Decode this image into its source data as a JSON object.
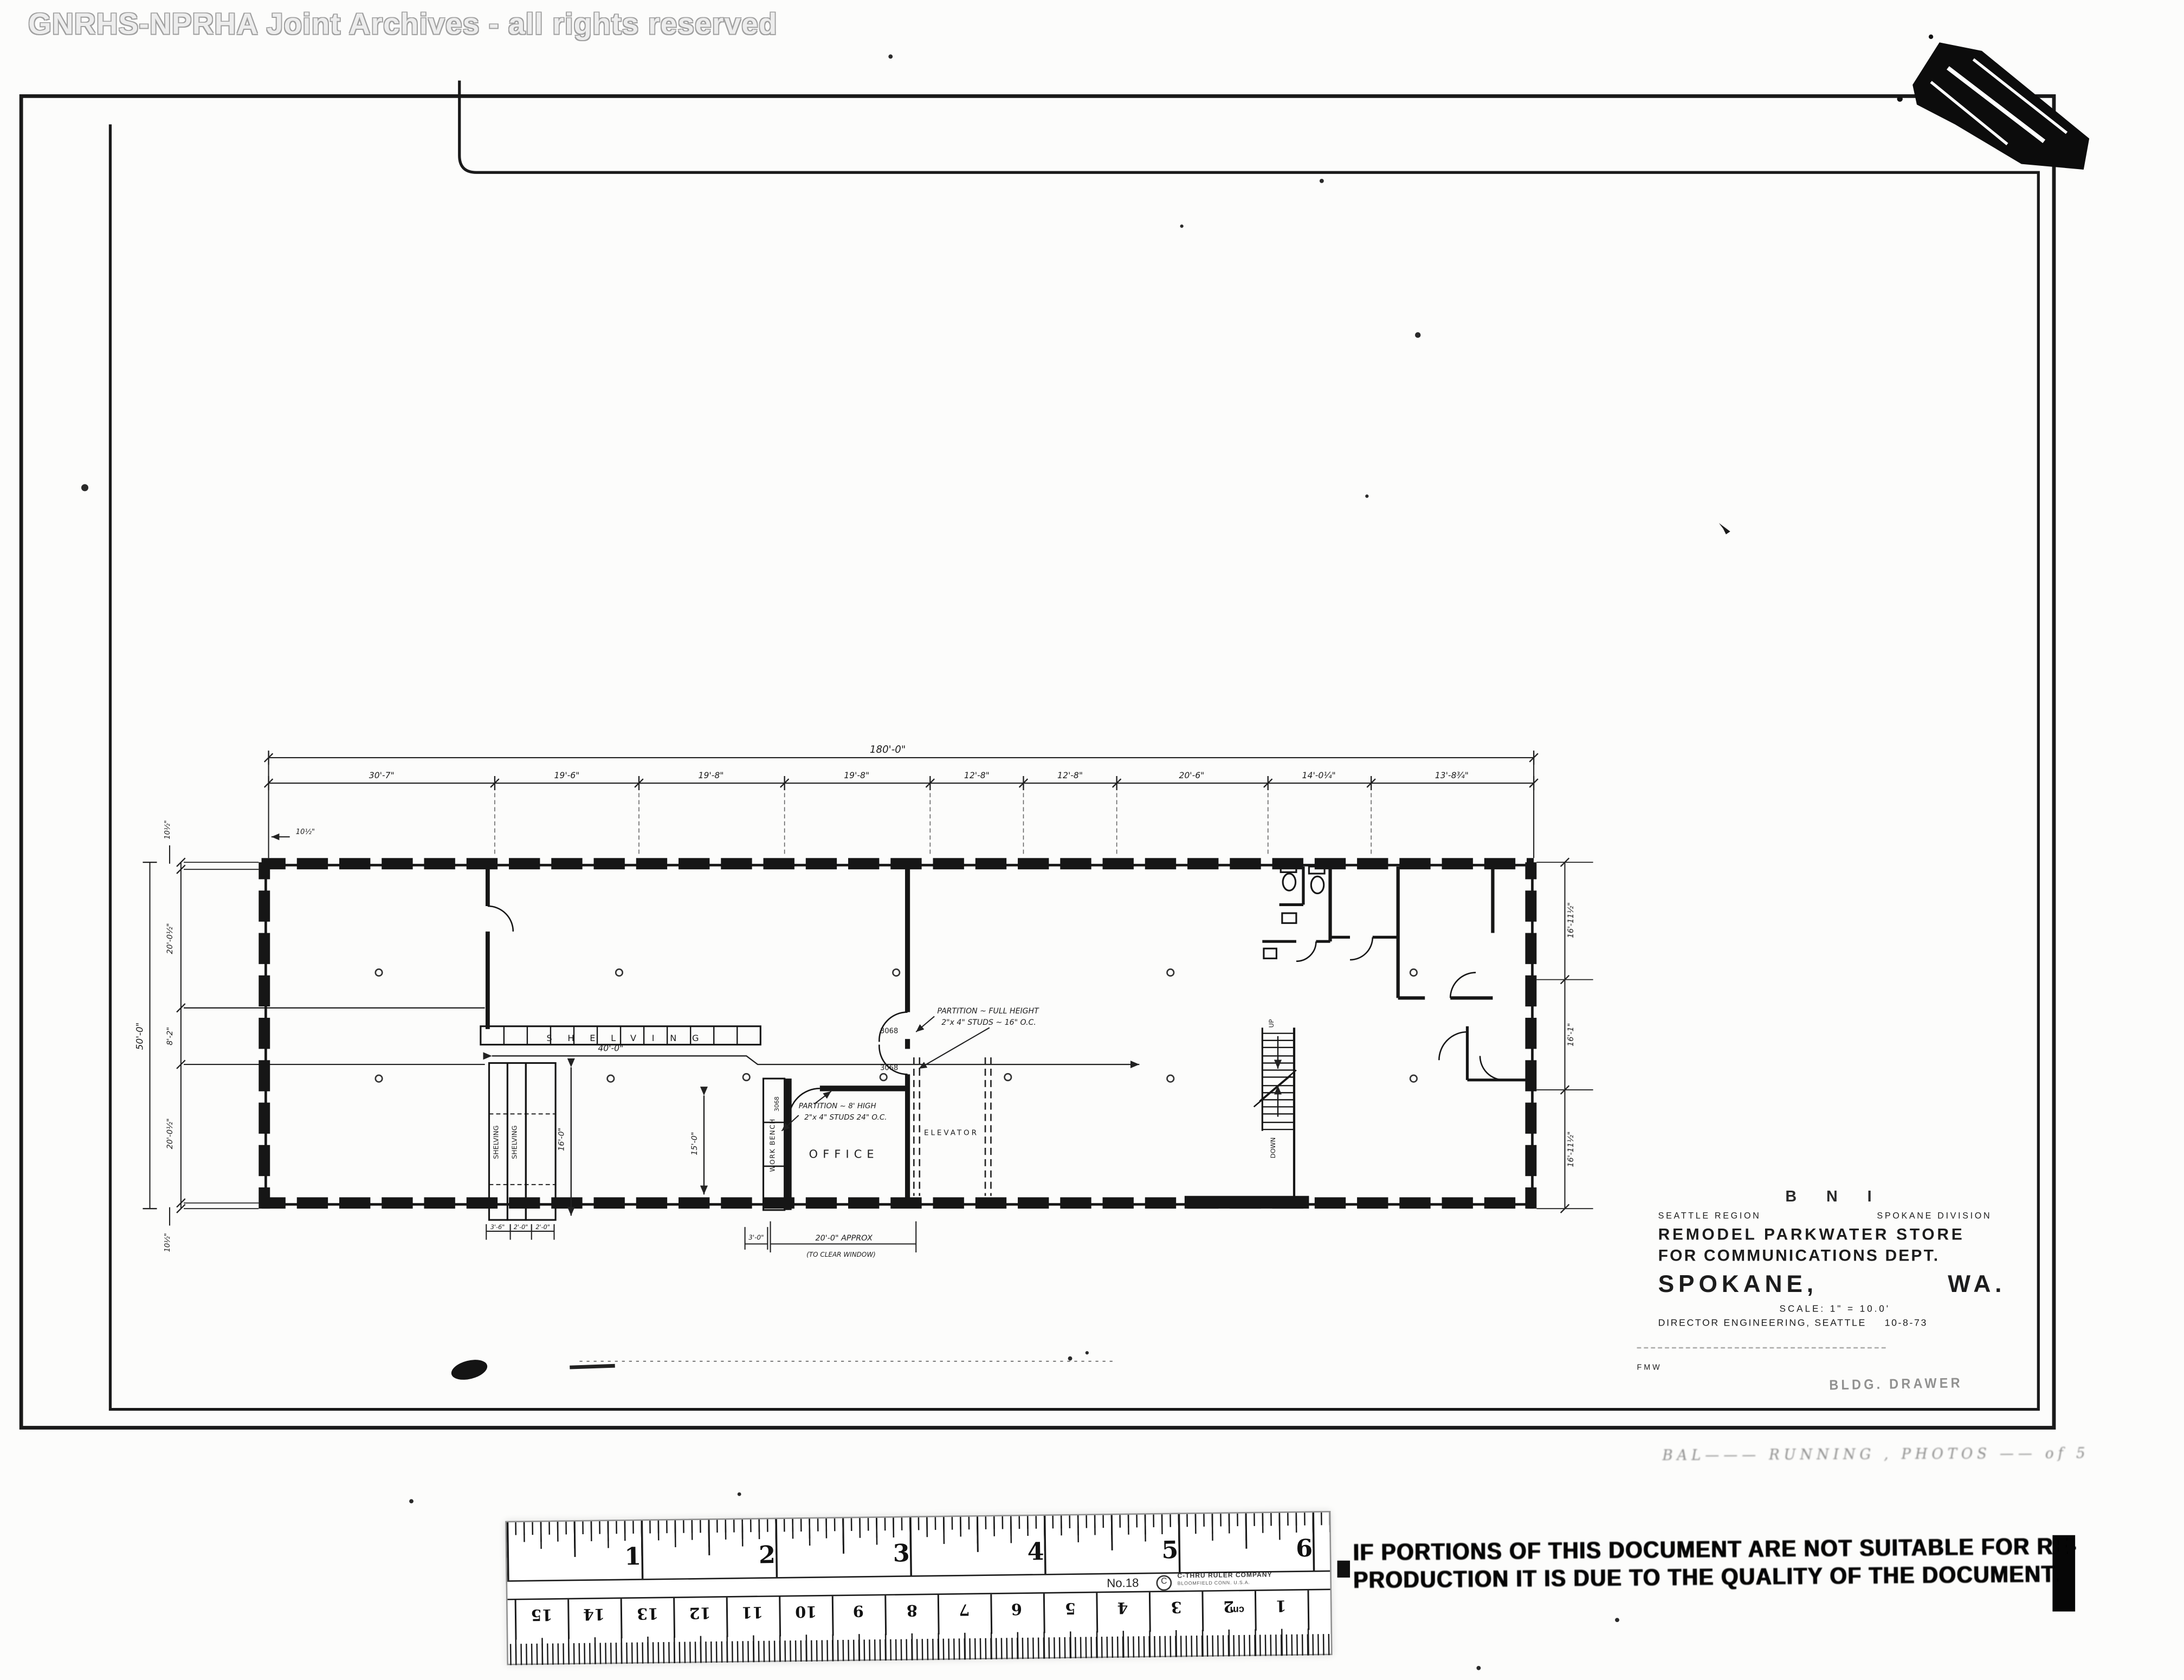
{
  "watermark": "GNRHS-NPRHA Joint Archives - all rights reserved",
  "plan": {
    "dim_overall_top": "180'-0\"",
    "dim_segments_top": [
      "30'-7\"",
      "19'-6\"",
      "19'-8\"",
      "19'-8\"",
      "12'-8\"",
      "12'-8\"",
      "20'-6\"",
      "14'-0¼\"",
      "13'-8¾\""
    ],
    "dim_offset_top_left": "10½\"",
    "dim_left": {
      "overall": "50'-0\"",
      "top_offset": "10½\"",
      "upper": "20'-0½\"",
      "middle": "8'-2\"",
      "lower": "20'-0½\"",
      "bottom_offset": "10½\""
    },
    "dim_right": {
      "top": "16'-11½\"",
      "middle": "16'-1\"",
      "bottom": "16'-11½\""
    },
    "dim_shelving_run": "40'-0\"",
    "dim_shelf_depth": "16'-0\"",
    "dim_office": "15'-0\"",
    "dim_shelf_widths": [
      "3'-6\"",
      "2'-0\"",
      "2'-0\""
    ],
    "dim_door": "3'-0\"",
    "dim_window": "20'-0\" APPROX",
    "dim_window_note": "(TO CLEAR WINDOW)",
    "labels": {
      "shelving_band": "SHELVING",
      "shelving_col_1": "SHELVING",
      "shelving_col_2": "SHELVING",
      "work_bench": "WORK BENCH",
      "office": "OFFICE",
      "elevator": "ELEVATOR",
      "up": "UP",
      "down": "DOWN"
    },
    "doors": {
      "d1": "3068",
      "d2": "3068",
      "d3": "3068"
    },
    "notes": {
      "partition_full_1": "PARTITION ~ FULL HEIGHT",
      "partition_full_2": "2\"x 4\" STUDS ~ 16\" O.C.",
      "partition_low_1": "PARTITION ~ 8' HIGH",
      "partition_low_2": "2\"x 4\" STUDS 24\" O.C."
    }
  },
  "title_block": {
    "railroad": "B N I",
    "region": "SEATTLE REGION",
    "division": "SPOKANE DIVISION",
    "title_1": "REMODEL PARKWATER STORE",
    "title_2": "FOR COMMUNICATIONS DEPT.",
    "city": "SPOKANE,",
    "state": "WA.",
    "scale": "SCALE: 1\" = 10.0'",
    "approval": "DIRECTOR ENGINEERING, SEATTLE",
    "date": "10-8-73",
    "initials": "FMW",
    "drawer_note": "BLDG. DRAWER",
    "handwriting": "BAL———  RUNNING ,  PHOTOS —— of  5"
  },
  "stamp": {
    "line1": "IF PORTIONS OF THIS DOCUMENT ARE NOT SUITABLE FOR RE-",
    "line2": "PRODUCTION IT IS DUE TO THE QUALITY OF THE DOCUMENT."
  },
  "ruler": {
    "model": "No.18",
    "brand": "C-THRU RULER COMPANY",
    "brand_sub": "BLOOMFIELD CONN. U.S.A.",
    "inches": [
      "1",
      "2",
      "3",
      "4",
      "5",
      "6"
    ],
    "cm": [
      "15",
      "14",
      "13",
      "12",
      "11",
      "10",
      "9",
      "8",
      "7",
      "6",
      "5",
      "4",
      "3",
      "2",
      "1"
    ],
    "cm_unit": "cm"
  }
}
